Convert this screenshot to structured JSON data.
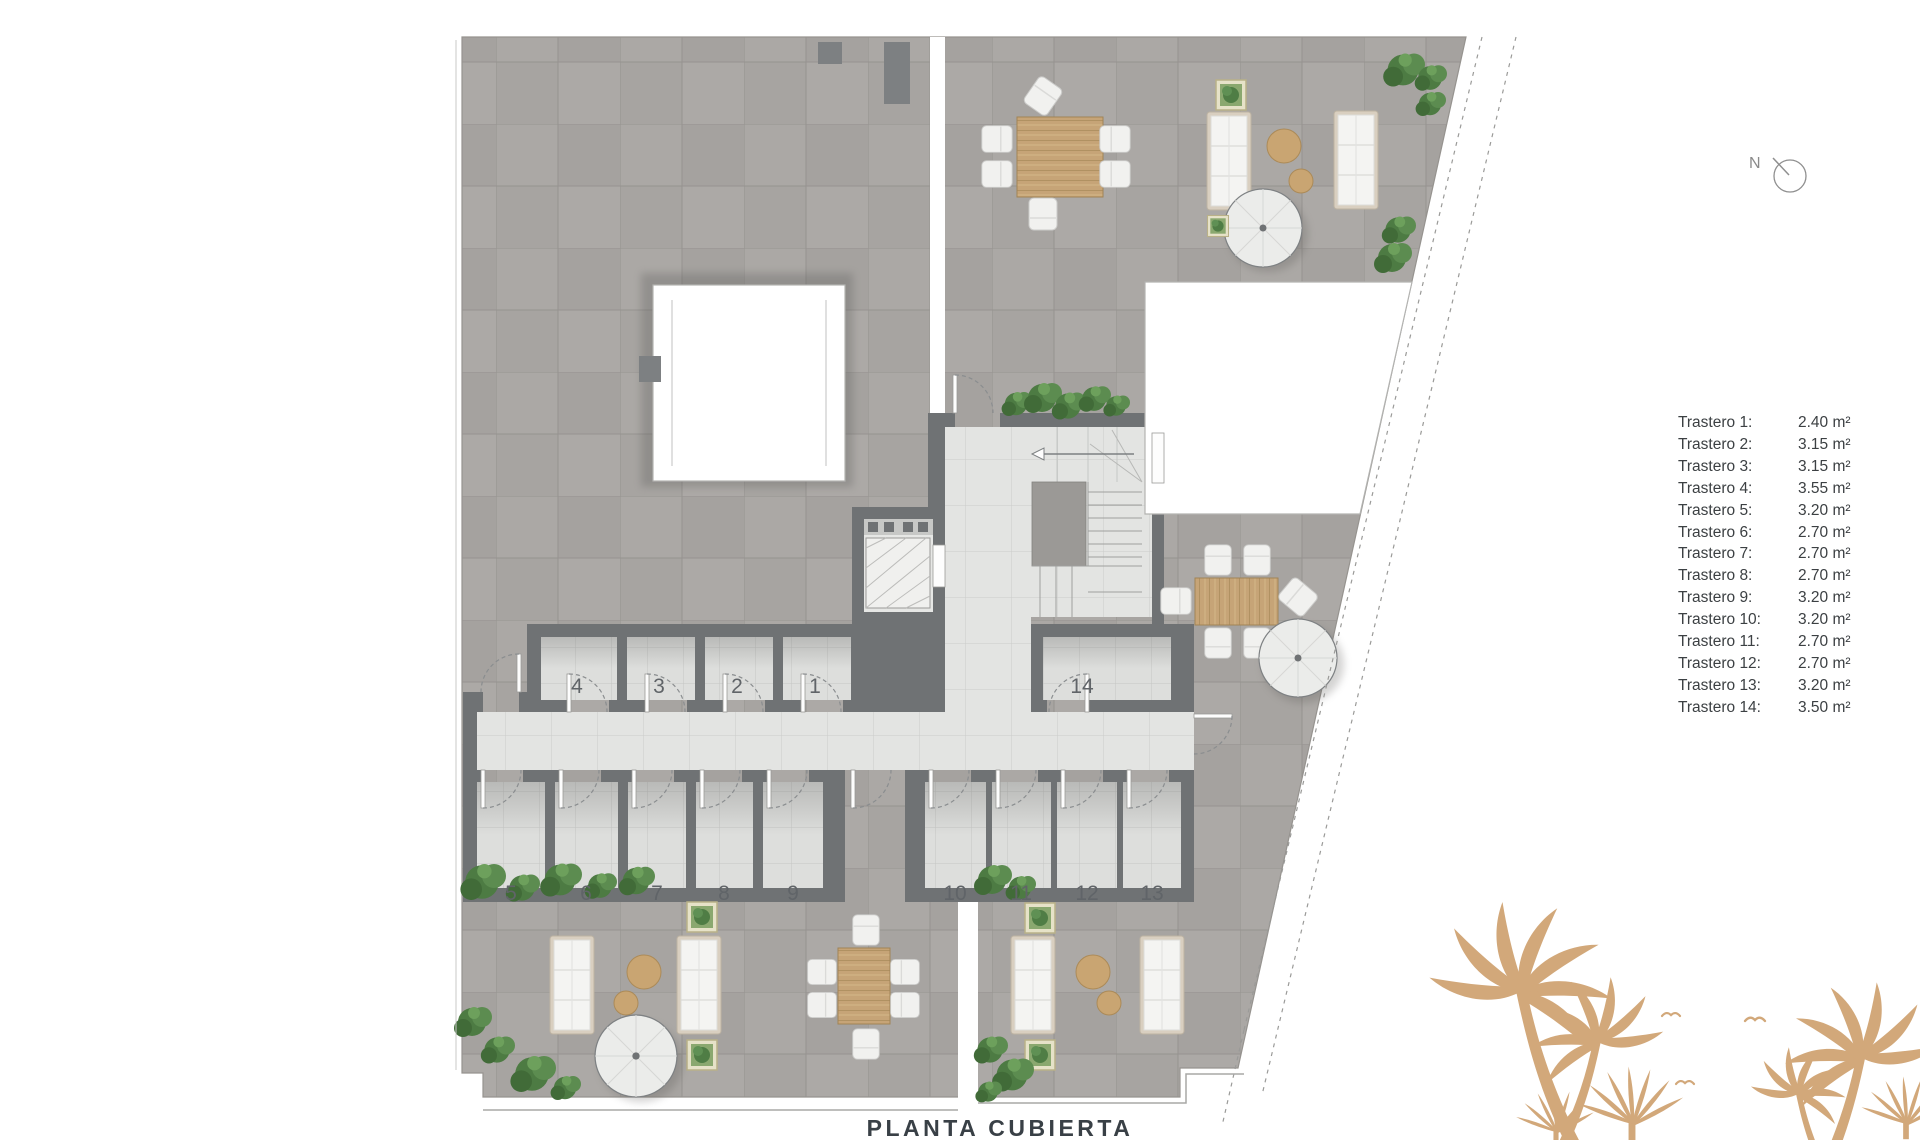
{
  "title": "PLANTA CUBIERTA",
  "compass": {
    "label": "N"
  },
  "legend": {
    "items": [
      {
        "label": "Trastero 1:",
        "area": "2.40 m²"
      },
      {
        "label": "Trastero 2:",
        "area": "3.15 m²"
      },
      {
        "label": "Trastero 3:",
        "area": "3.15 m²"
      },
      {
        "label": "Trastero 4:",
        "area": "3.55 m²"
      },
      {
        "label": "Trastero 5:",
        "area": "3.20 m²"
      },
      {
        "label": "Trastero 6:",
        "area": "2.70 m²"
      },
      {
        "label": "Trastero 7:",
        "area": "2.70 m²"
      },
      {
        "label": "Trastero 8:",
        "area": "2.70 m²"
      },
      {
        "label": "Trastero 9:",
        "area": "3.20 m²"
      },
      {
        "label": "Trastero 10:",
        "area": "3.20 m²"
      },
      {
        "label": "Trastero 11:",
        "area": "2.70 m²"
      },
      {
        "label": "Trastero 12:",
        "area": "2.70 m²"
      },
      {
        "label": "Trastero 13:",
        "area": "3.20 m²"
      },
      {
        "label": "Trastero 14:",
        "area": "3.50 m²"
      }
    ]
  },
  "plan": {
    "rooms": [
      {
        "number": "1"
      },
      {
        "number": "2"
      },
      {
        "number": "3"
      },
      {
        "number": "4"
      },
      {
        "number": "5"
      },
      {
        "number": "6"
      },
      {
        "number": "7"
      },
      {
        "number": "8"
      },
      {
        "number": "9"
      },
      {
        "number": "10"
      },
      {
        "number": "11"
      },
      {
        "number": "12"
      },
      {
        "number": "13"
      },
      {
        "number": "14"
      }
    ]
  },
  "colors": {
    "wall": "#6f7274",
    "outdoor_tile": "#a9a6a3",
    "indoor_tile": "#e3e4e2",
    "wood": "#c6a477",
    "palm": "#d2a87a",
    "greenery": "#55844a",
    "text": "#3c4043"
  }
}
